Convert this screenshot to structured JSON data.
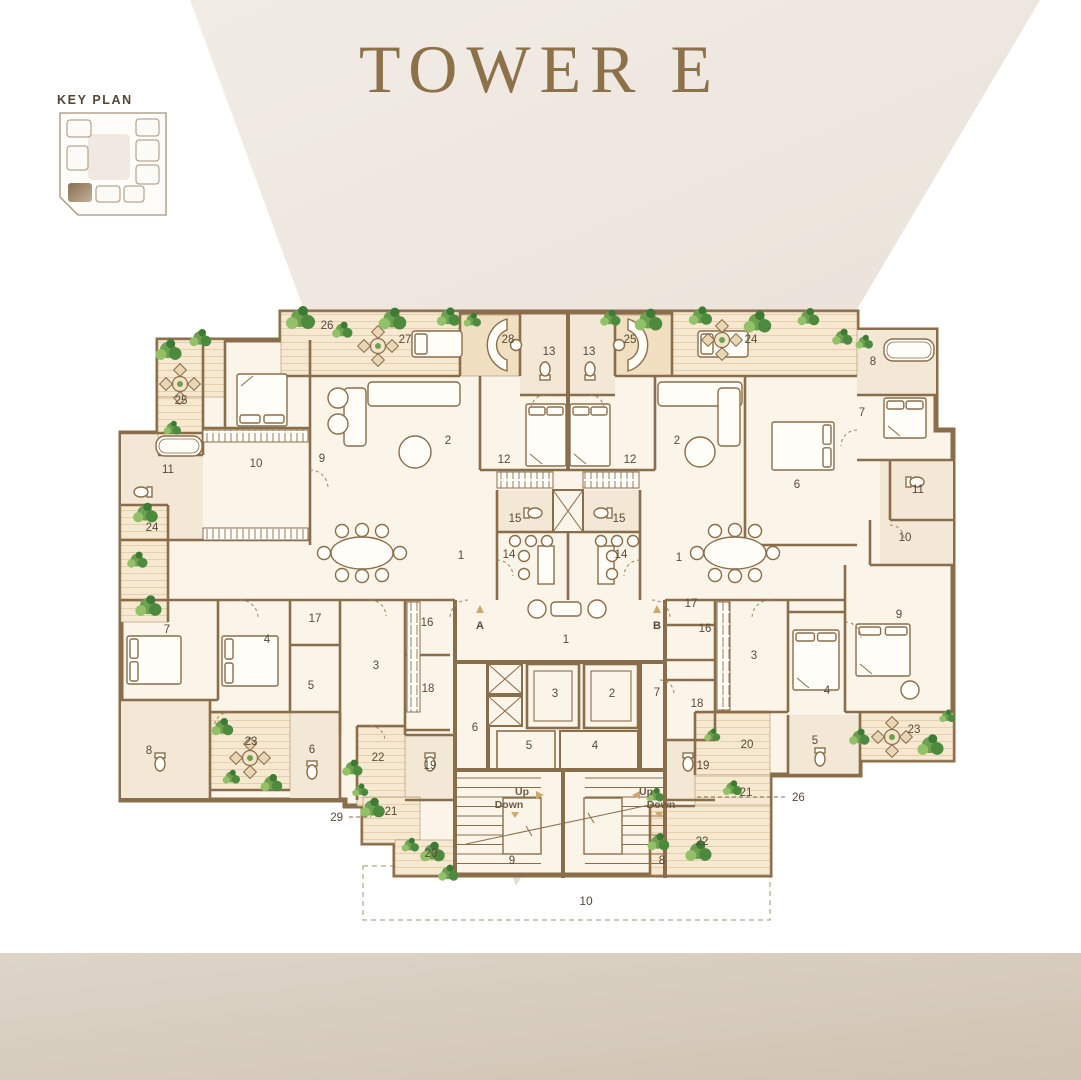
{
  "title": "TOWER E",
  "key_plan": {
    "label": "KEY PLAN"
  },
  "plan": {
    "room_labels": [
      {
        "t": "26",
        "x": 327,
        "y": 329
      },
      {
        "t": "27",
        "x": 405,
        "y": 343
      },
      {
        "t": "28",
        "x": 508,
        "y": 343
      },
      {
        "t": "25",
        "x": 630,
        "y": 343
      },
      {
        "t": "24",
        "x": 751,
        "y": 343
      },
      {
        "t": "13",
        "x": 549,
        "y": 355
      },
      {
        "t": "13",
        "x": 589,
        "y": 355
      },
      {
        "t": "25",
        "x": 181,
        "y": 404
      },
      {
        "t": "8",
        "x": 873,
        "y": 365
      },
      {
        "t": "7",
        "x": 862,
        "y": 416
      },
      {
        "t": "11",
        "x": 168,
        "y": 473
      },
      {
        "t": "10",
        "x": 256,
        "y": 467
      },
      {
        "t": "9",
        "x": 322,
        "y": 462
      },
      {
        "t": "2",
        "x": 448,
        "y": 444
      },
      {
        "t": "12",
        "x": 504,
        "y": 463
      },
      {
        "t": "12",
        "x": 630,
        "y": 463
      },
      {
        "t": "2",
        "x": 677,
        "y": 444
      },
      {
        "t": "6",
        "x": 797,
        "y": 488
      },
      {
        "t": "24",
        "x": 152,
        "y": 531
      },
      {
        "t": "11",
        "x": 918,
        "y": 493
      },
      {
        "t": "10",
        "x": 905,
        "y": 541
      },
      {
        "t": "15",
        "x": 515,
        "y": 522
      },
      {
        "t": "14",
        "x": 509,
        "y": 558
      },
      {
        "t": "1",
        "x": 461,
        "y": 559
      },
      {
        "t": "1",
        "x": 679,
        "y": 561
      },
      {
        "t": "14",
        "x": 621,
        "y": 558
      },
      {
        "t": "15",
        "x": 619,
        "y": 522
      },
      {
        "t": "9",
        "x": 899,
        "y": 618
      },
      {
        "t": "7",
        "x": 167,
        "y": 633
      },
      {
        "t": "17",
        "x": 315,
        "y": 622
      },
      {
        "t": "4",
        "x": 267,
        "y": 643
      },
      {
        "t": "16",
        "x": 427,
        "y": 626
      },
      {
        "t": "3",
        "x": 376,
        "y": 669
      },
      {
        "t": "5",
        "x": 311,
        "y": 689
      },
      {
        "t": "18",
        "x": 428,
        "y": 692
      },
      {
        "t": "17",
        "x": 691,
        "y": 607
      },
      {
        "t": "16",
        "x": 705,
        "y": 632
      },
      {
        "t": "3",
        "x": 754,
        "y": 659
      },
      {
        "t": "18",
        "x": 697,
        "y": 707
      },
      {
        "t": "4",
        "x": 827,
        "y": 694
      },
      {
        "t": "8",
        "x": 149,
        "y": 754
      },
      {
        "t": "23",
        "x": 251,
        "y": 745
      },
      {
        "t": "6",
        "x": 312,
        "y": 753
      },
      {
        "t": "22",
        "x": 378,
        "y": 761
      },
      {
        "t": "19",
        "x": 430,
        "y": 769
      },
      {
        "t": "21",
        "x": 391,
        "y": 815
      },
      {
        "t": "20",
        "x": 431,
        "y": 857
      },
      {
        "t": "20",
        "x": 747,
        "y": 748
      },
      {
        "t": "5",
        "x": 815,
        "y": 744
      },
      {
        "t": "23",
        "x": 914,
        "y": 733
      },
      {
        "t": "19",
        "x": 703,
        "y": 769
      },
      {
        "t": "21",
        "x": 746,
        "y": 796
      },
      {
        "t": "22",
        "x": 702,
        "y": 845
      },
      {
        "t": "9",
        "x": 512,
        "y": 864
      },
      {
        "t": "8",
        "x": 662,
        "y": 864
      },
      {
        "t": "1",
        "x": 566,
        "y": 643
      },
      {
        "t": "3",
        "x": 555,
        "y": 697
      },
      {
        "t": "2",
        "x": 612,
        "y": 697
      },
      {
        "t": "7",
        "x": 657,
        "y": 696
      },
      {
        "t": "6",
        "x": 475,
        "y": 731
      },
      {
        "t": "5",
        "x": 529,
        "y": 749
      },
      {
        "t": "4",
        "x": 595,
        "y": 749
      }
    ],
    "stair_labels": [
      {
        "t": "Up",
        "x": 522,
        "y": 795
      },
      {
        "t": "Down",
        "x": 509,
        "y": 808
      },
      {
        "t": "Up",
        "x": 646,
        "y": 795
      },
      {
        "t": "Down",
        "x": 661,
        "y": 808
      }
    ],
    "core_letters": [
      {
        "t": "A",
        "x": 480,
        "y": 629
      },
      {
        "t": "B",
        "x": 657,
        "y": 629
      }
    ],
    "leader_labels": [
      {
        "t": "29",
        "x": 343,
        "y": 821,
        "anchor": "end"
      },
      {
        "t": "26",
        "x": 792,
        "y": 801,
        "anchor": "start"
      }
    ],
    "site_area_label": {
      "t": "10",
      "x": 586,
      "y": 905
    }
  }
}
